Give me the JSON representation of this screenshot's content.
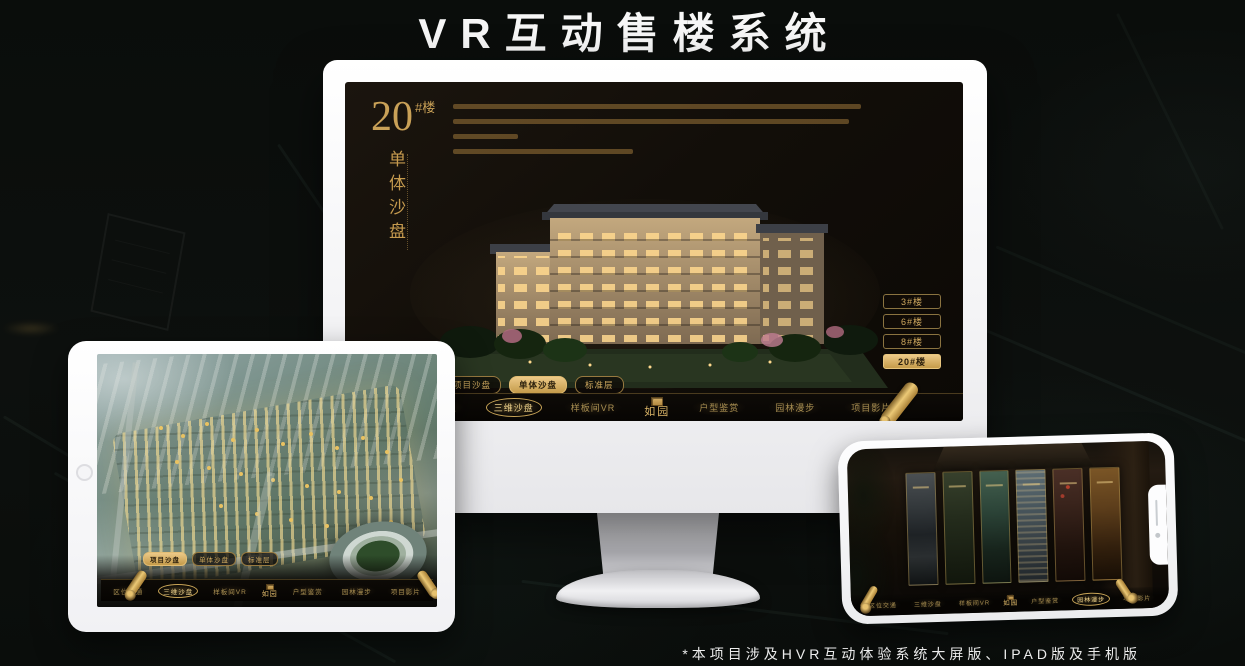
{
  "page": {
    "title": "VR互动售楼系统",
    "footnote": "*本项目涉及HVR互动体验系统大屏版、IPAD版及手机版"
  },
  "colors": {
    "gold": "#c9a55a",
    "gold_bright": "#ecc988",
    "screen_bg": "#120e09",
    "device_body": "#f4f4f6"
  },
  "app_nav": {
    "logo": "如园",
    "items": [
      "区位交通",
      "三维沙盘",
      "样板间VR",
      "户型鉴赏",
      "园林漫步",
      "项目影片"
    ],
    "subnav": [
      "项目沙盘",
      "单体沙盘",
      "标准层"
    ]
  },
  "monitor": {
    "headline": {
      "number": "20",
      "suffix": "#楼",
      "subtitle_vertical": "单体沙盘"
    },
    "floor_buttons": [
      {
        "label": "3#楼",
        "active": false
      },
      {
        "label": "6#楼",
        "active": false
      },
      {
        "label": "8#楼",
        "active": false
      },
      {
        "label": "20#楼",
        "active": true
      }
    ],
    "active_subnav": "单体沙盘",
    "active_nav": "三维沙盘"
  },
  "tablet": {
    "active_subnav": "项目沙盘",
    "active_nav": "三维沙盘"
  },
  "phone": {
    "active_nav": "园林漫步"
  }
}
